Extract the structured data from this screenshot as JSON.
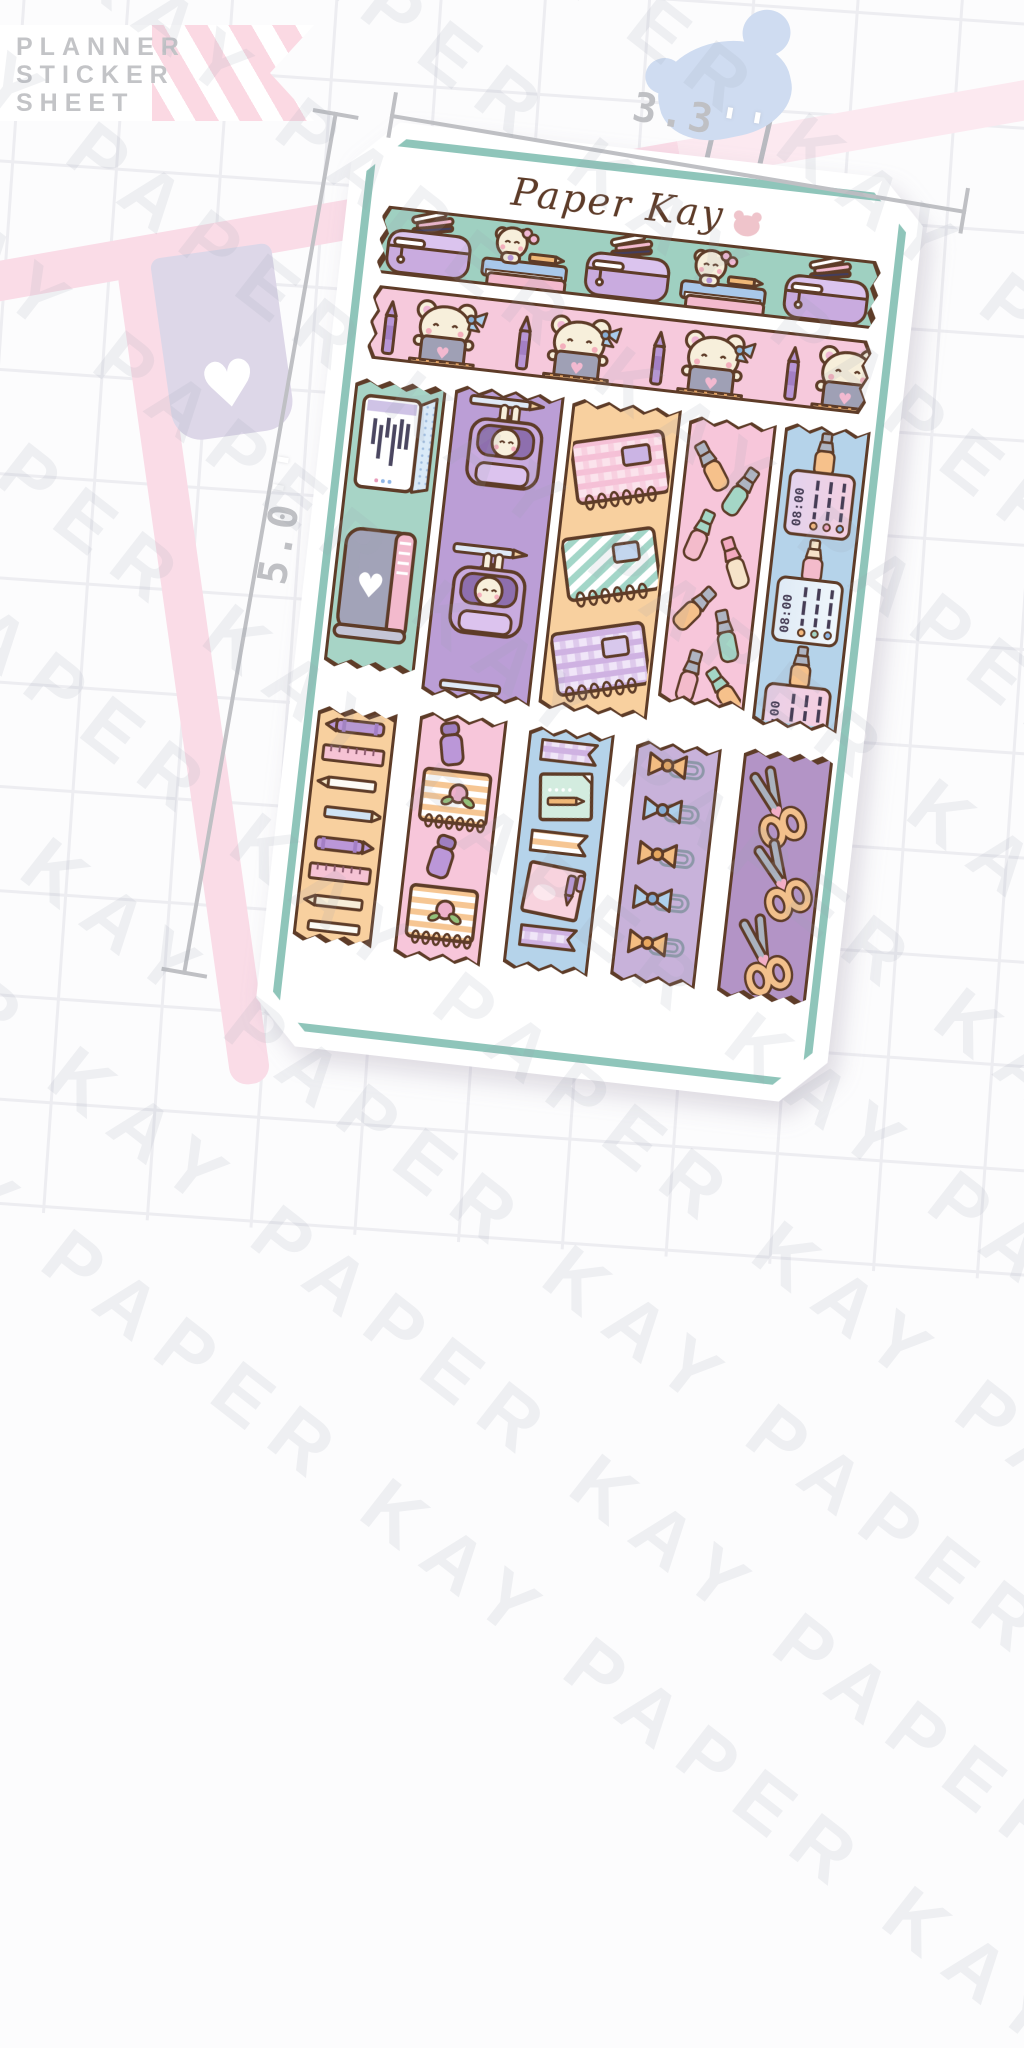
{
  "badge": {
    "lines": [
      "PLANNER",
      "STICKER",
      "SHEET"
    ]
  },
  "brand": {
    "logo": "Paper Kay"
  },
  "watermark": {
    "text": "PAPER KAY"
  },
  "annotations": {
    "width_value": "3.3",
    "width_unit": "''",
    "height_value": "5.0",
    "height_unit": "''"
  },
  "sheet": {
    "schedule_times": [
      "08:00",
      "08:00",
      "08:00"
    ]
  },
  "icons": {
    "heart": "♥"
  },
  "colors": {
    "brown_outline": "#5e3c28",
    "teal_border": "#8fc5ba",
    "washi_teal": "#9fd0c1",
    "washi_pink": "#f6c9dc",
    "sticker_teal": "#a7d4c6",
    "sticker_purple": "#bb9ed6",
    "sticker_orange": "#f8d09f",
    "sticker_pink": "#f7c6da",
    "sticker_blue": "#b5d3ea",
    "sticker_lavender": "#c8b2da",
    "sticker_plum": "#b394c6",
    "pink_frame": "#fadce7",
    "bookmark": "#ddd7e8",
    "bear_blob": "#cfdcf1",
    "grid_line": "#ededf1",
    "dim_gray": "#bfc0c4",
    "logo_brown": "#5d3b28"
  }
}
